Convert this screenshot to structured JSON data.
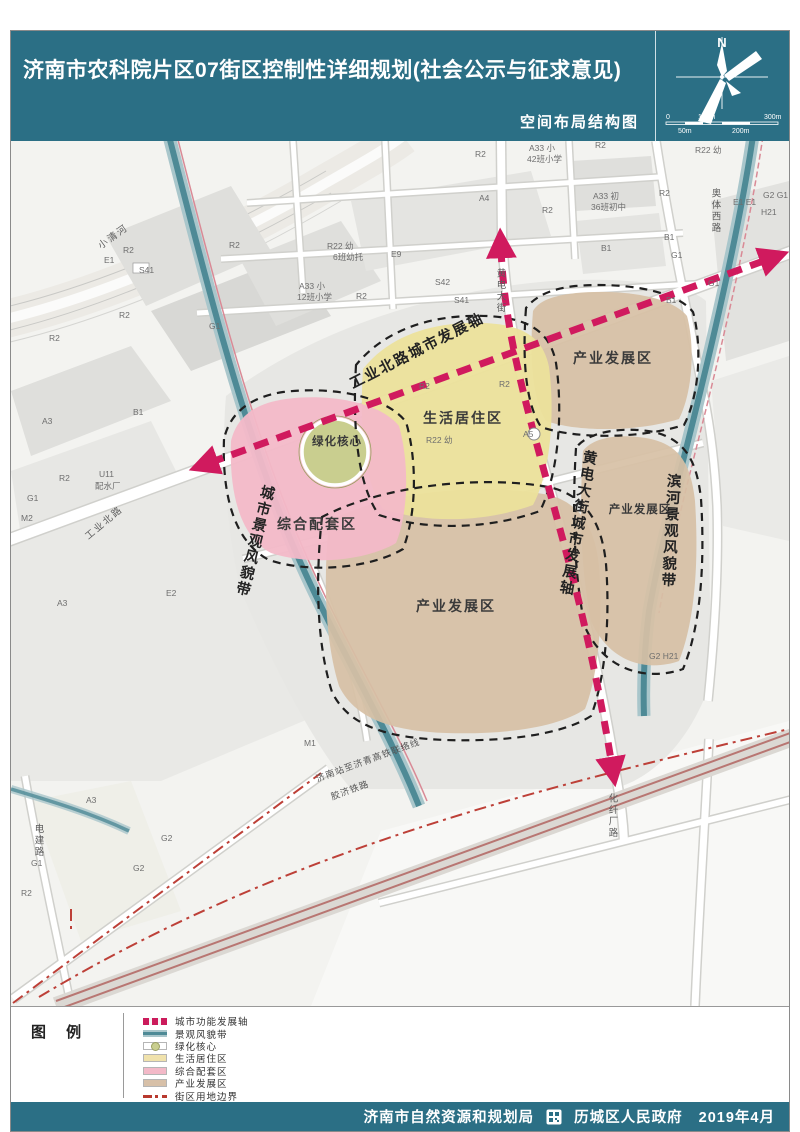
{
  "header": {
    "title": "济南市农科院片区07街区控制性详细规划(社会公示与征求意见)",
    "subtitle": "空间布局结构图",
    "compass_label": "N",
    "scale_ticks_top": [
      "0",
      "100m",
      "300m"
    ],
    "scale_ticks_bottom": [
      "50m",
      "200m"
    ]
  },
  "colors": {
    "header_teal": "#2B6F85",
    "axis_magenta": "#D01A5E",
    "landscape_band_teal": "#4E8A96",
    "green_core": "#C9CE8F",
    "residential_yellow": "#EFE3A6",
    "mixed_pink": "#F3B9C8",
    "industry_tan": "#D7C0A8",
    "block_boundary_red": "#B8392E"
  },
  "legend": {
    "title": "图 例",
    "items": [
      {
        "label": "城市功能发展轴",
        "type": "axis"
      },
      {
        "label": "景观风貌带",
        "type": "band"
      },
      {
        "label": "绿化核心",
        "type": "core"
      },
      {
        "label": "生活居住区",
        "type": "residential"
      },
      {
        "label": "综合配套区",
        "type": "mixed"
      },
      {
        "label": "产业发展区",
        "type": "industry"
      },
      {
        "label": "街区用地边界",
        "type": "boundary"
      }
    ]
  },
  "footer": {
    "left_agency": "济南市自然资源和规划局",
    "right_agency": "历城区人民政府",
    "date": "2019年4月"
  },
  "map": {
    "labels": [
      {
        "text": "工业北路城市发展轴",
        "x": 408,
        "y": 214,
        "rotate": -27,
        "cls": "axis",
        "name": "axis-label-gongyebeilu"
      },
      {
        "text": "城市景观风貌带",
        "x": 243,
        "y": 400,
        "vertical": true,
        "rotate": 14,
        "cls": "axis",
        "name": "axis-label-cityscape"
      },
      {
        "text": "黄电大街城市发展轴",
        "x": 566,
        "y": 382,
        "vertical": true,
        "rotate": 10,
        "cls": "axis",
        "name": "axis-label-huangdian"
      },
      {
        "text": "滨河景观风貌带",
        "x": 659,
        "y": 390,
        "vertical": true,
        "rotate": 3,
        "cls": "axis",
        "name": "axis-label-binhe"
      },
      {
        "text": "生活居住区",
        "x": 452,
        "y": 282,
        "cls": "zone",
        "name": "zone-label-residential"
      },
      {
        "text": "综合配套区",
        "x": 306,
        "y": 388,
        "cls": "zone",
        "name": "zone-label-mixed"
      },
      {
        "text": "绿化核心",
        "x": 326,
        "y": 304,
        "cls": "zone-sm",
        "name": "zone-label-green-core"
      },
      {
        "text": "产业发展区",
        "x": 602,
        "y": 222,
        "cls": "zone",
        "name": "zone-label-industry-ne"
      },
      {
        "text": "产业发展区",
        "x": 629,
        "y": 372,
        "cls": "zone-sm",
        "name": "zone-label-industry-e"
      },
      {
        "text": "产业发展区",
        "x": 445,
        "y": 470,
        "cls": "zone",
        "name": "zone-label-industry-c"
      },
      {
        "text": "小清河",
        "x": 104,
        "y": 98,
        "rotate": -36,
        "cls": "road",
        "name": "road-label-xiaoqinghe"
      },
      {
        "text": "工业北路",
        "x": 95,
        "y": 384,
        "rotate": -40,
        "cls": "road",
        "name": "road-label-gongyebeilu"
      },
      {
        "text": "奥体西路",
        "x": 704,
        "y": 70,
        "vertical": true,
        "cls": "road",
        "name": "road-label-aotixilu"
      },
      {
        "text": "黄电大街",
        "x": 489,
        "y": 150,
        "vertical": true,
        "cls": "road",
        "name": "road-label-huangdiandajie"
      },
      {
        "text": "电建路",
        "x": 27,
        "y": 700,
        "vertical": true,
        "cls": "road",
        "name": "road-label-dianjianlu"
      },
      {
        "text": "化纤厂路",
        "x": 601,
        "y": 675,
        "vertical": true,
        "cls": "road",
        "name": "road-label-huaxianchanglu"
      },
      {
        "text": "济南站至济青高铁联络线",
        "x": 358,
        "y": 622,
        "rotate": -20,
        "cls": "rail",
        "name": "rail-label-lianluoxian"
      },
      {
        "text": "胶济铁路",
        "x": 340,
        "y": 652,
        "rotate": -20,
        "cls": "rail",
        "name": "rail-label-jiaoji"
      },
      {
        "text": "R2",
        "x": 112,
        "y": 112
      },
      {
        "text": "E1",
        "x": 93,
        "y": 122
      },
      {
        "text": "S41",
        "x": 128,
        "y": 132
      },
      {
        "text": "R2",
        "x": 38,
        "y": 200
      },
      {
        "text": "R2",
        "x": 108,
        "y": 177
      },
      {
        "text": "R2",
        "x": 218,
        "y": 107
      },
      {
        "text": "G1",
        "x": 198,
        "y": 188
      },
      {
        "text": "A33 小",
        "x": 288,
        "y": 148
      },
      {
        "text": "12班小学",
        "x": 286,
        "y": 159
      },
      {
        "text": "R22 幼",
        "x": 316,
        "y": 108
      },
      {
        "text": "6班幼托",
        "x": 322,
        "y": 119
      },
      {
        "text": "E9",
        "x": 380,
        "y": 116
      },
      {
        "text": "R2",
        "x": 345,
        "y": 158
      },
      {
        "text": "A4",
        "x": 468,
        "y": 60
      },
      {
        "text": "R2",
        "x": 464,
        "y": 16
      },
      {
        "text": "A33 小",
        "x": 518,
        "y": 10
      },
      {
        "text": "42班小学",
        "x": 516,
        "y": 21
      },
      {
        "text": "R2",
        "x": 531,
        "y": 72
      },
      {
        "text": "A33 初",
        "x": 582,
        "y": 58
      },
      {
        "text": "36班初中",
        "x": 580,
        "y": 69
      },
      {
        "text": "R2",
        "x": 648,
        "y": 55
      },
      {
        "text": "R2",
        "x": 584,
        "y": 7
      },
      {
        "text": "R22 幼",
        "x": 684,
        "y": 12
      },
      {
        "text": "B1",
        "x": 653,
        "y": 99
      },
      {
        "text": "G1",
        "x": 660,
        "y": 117
      },
      {
        "text": "B1",
        "x": 590,
        "y": 110
      },
      {
        "text": "G2 G1",
        "x": 752,
        "y": 57
      },
      {
        "text": "H21",
        "x": 750,
        "y": 74
      },
      {
        "text": "E1 E1",
        "x": 722,
        "y": 64
      },
      {
        "text": "S42",
        "x": 424,
        "y": 144
      },
      {
        "text": "S41",
        "x": 443,
        "y": 162
      },
      {
        "text": "U11",
        "x": 88,
        "y": 336
      },
      {
        "text": "配水厂",
        "x": 84,
        "y": 348
      },
      {
        "text": "M2",
        "x": 10,
        "y": 380
      },
      {
        "text": "A3",
        "x": 31,
        "y": 283
      },
      {
        "text": "R2",
        "x": 48,
        "y": 340
      },
      {
        "text": "B1",
        "x": 122,
        "y": 274
      },
      {
        "text": "G1",
        "x": 16,
        "y": 360
      },
      {
        "text": "E2",
        "x": 155,
        "y": 455
      },
      {
        "text": "A3",
        "x": 46,
        "y": 465
      },
      {
        "text": "A3",
        "x": 75,
        "y": 662
      },
      {
        "text": "G2",
        "x": 150,
        "y": 700
      },
      {
        "text": "G2",
        "x": 122,
        "y": 730
      },
      {
        "text": "G1",
        "x": 20,
        "y": 725
      },
      {
        "text": "R2",
        "x": 10,
        "y": 755
      },
      {
        "text": "M1",
        "x": 293,
        "y": 605
      },
      {
        "text": "B1",
        "x": 655,
        "y": 162
      },
      {
        "text": "G1",
        "x": 697,
        "y": 145
      },
      {
        "text": "R2",
        "x": 408,
        "y": 248
      },
      {
        "text": "R2",
        "x": 488,
        "y": 246
      },
      {
        "text": "R22 幼",
        "x": 415,
        "y": 302
      },
      {
        "text": "A5",
        "x": 512,
        "y": 296
      },
      {
        "text": "G2 H21",
        "x": 638,
        "y": 518
      }
    ]
  }
}
